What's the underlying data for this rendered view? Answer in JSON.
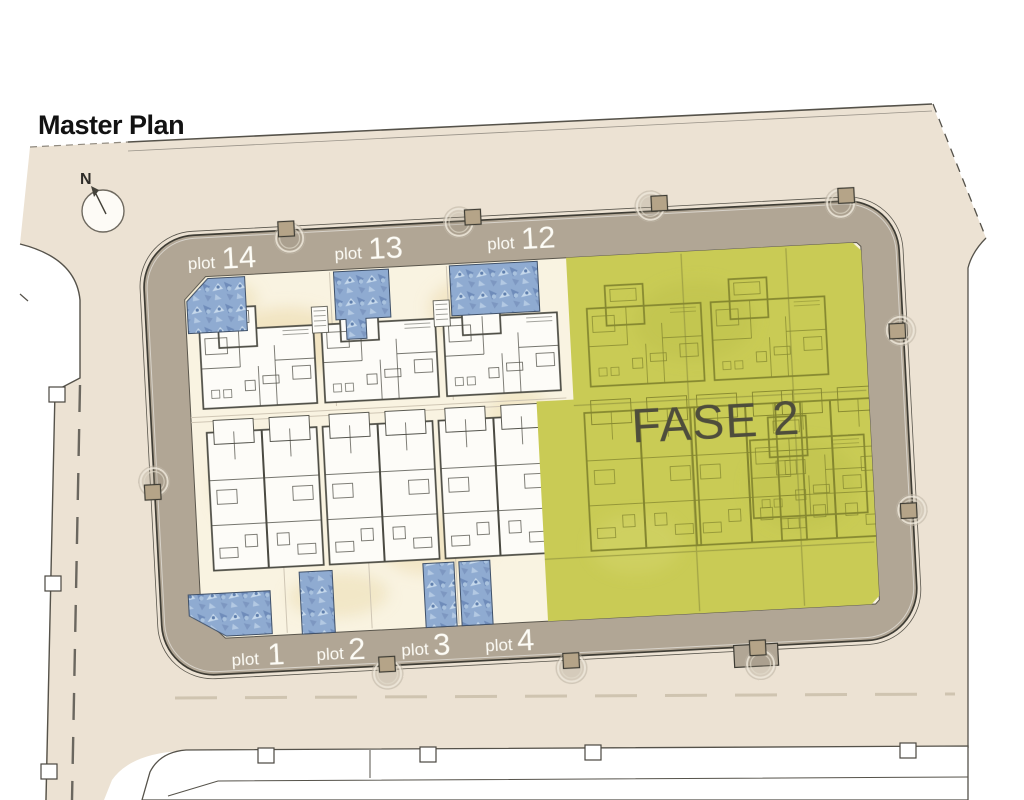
{
  "title": "Master Plan",
  "compass": {
    "label": "N"
  },
  "phase": {
    "label": "FASE 2",
    "color": "#c9cb55",
    "text_color": "#4e4d3c"
  },
  "plots": {
    "top": [
      {
        "word": "plot",
        "number": "14"
      },
      {
        "word": "plot",
        "number": "13"
      },
      {
        "word": "plot",
        "number": "12"
      }
    ],
    "bottom": [
      {
        "word": "plot",
        "number": "1"
      },
      {
        "word": "plot",
        "number": "2"
      },
      {
        "word": "plot",
        "number": "3"
      },
      {
        "word": "plot",
        "number": "4"
      }
    ]
  },
  "colors": {
    "street": "#ece2d3",
    "ring_road": "#b1a695",
    "floor": "#f9f3e1",
    "pool_base": "#8fabd1",
    "outline": "#3e3c34"
  }
}
